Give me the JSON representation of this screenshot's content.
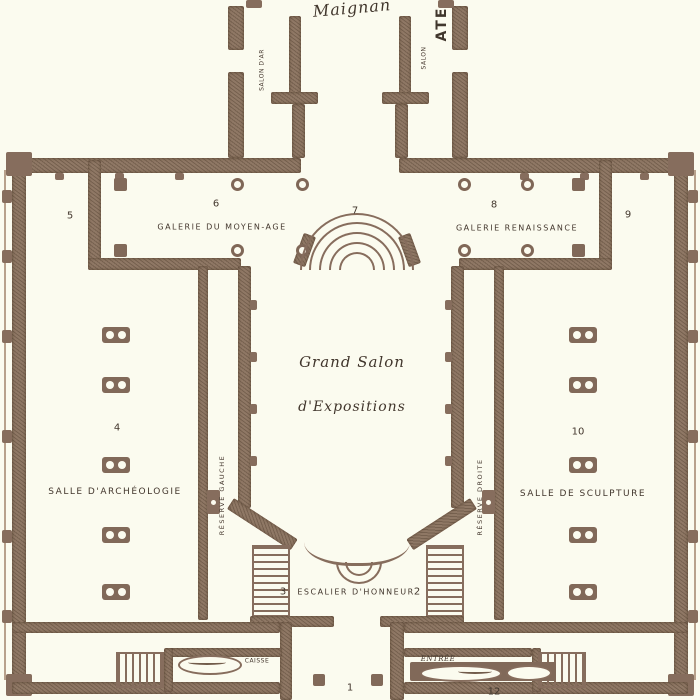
{
  "plan": {
    "type": "museum-floor-plan",
    "title_script": "Maignan",
    "rooms": {
      "salon_art": "SALON D'AR",
      "salon_right": "SALON",
      "atelier": "ATE",
      "galerie_moyen_age": "GALERIE DU MOYEN-AGE",
      "galerie_renaissance": "GALERIE RENAISSANCE",
      "grand_salon_line1": "Grand Salon",
      "grand_salon_line2": "d'Expositions",
      "salle_archeologie": "SALLE D'ARCHÉOLOGIE",
      "salle_sculpture": "SALLE DE SCULPTURE",
      "reserve_gauche": "RÉSERVE GAUCHE",
      "reserve_droite": "RÉSERVE DROITE",
      "escalier_honneur": "ESCALIER D'HONNEUR",
      "caisse": "CAISSE",
      "entree": "ENTRÉE"
    },
    "numbers": {
      "n1": "1",
      "n2": "2",
      "n3": "3",
      "n4": "4",
      "n5": "5",
      "n6": "6",
      "n7": "7",
      "n8": "8",
      "n9": "9",
      "n10": "10",
      "n12": "12"
    },
    "colors": {
      "wall": "#8d7462",
      "wall_dark": "#7f6556",
      "paper": "#fbf9f4",
      "ink": "#42362b"
    }
  }
}
